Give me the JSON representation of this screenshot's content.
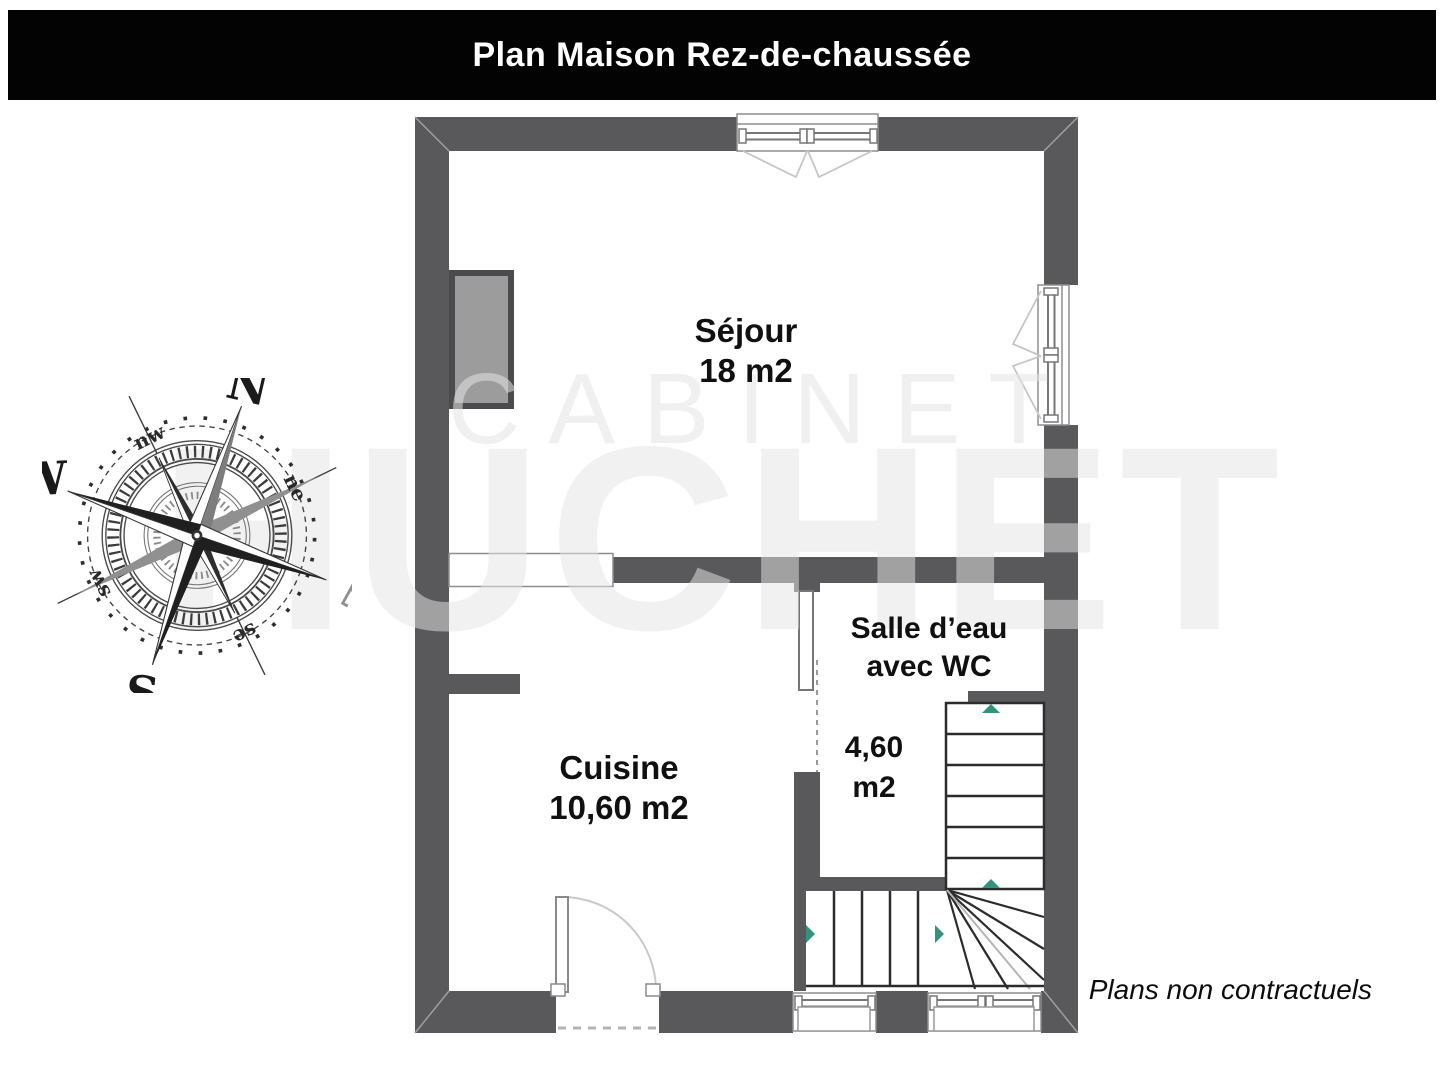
{
  "header": {
    "title": "Plan Maison Rez-de-chaussée"
  },
  "watermark": {
    "line1": "CABINET",
    "line2": "HUCHET"
  },
  "compass": {
    "north": "N",
    "south": "S",
    "east": "E",
    "west": "W",
    "northeast": "ne",
    "northwest": "nw",
    "southeast": "se",
    "southwest": "sw"
  },
  "rooms": {
    "sejour": {
      "name": "Séjour",
      "area": "18 m2"
    },
    "cuisine": {
      "name": "Cuisine",
      "area": "10,60 m2"
    },
    "salle_eau": {
      "name_line1": "Salle d’eau",
      "name_line2": "avec WC",
      "area_line1": "4,60",
      "area_line2": "m2"
    }
  },
  "footer": {
    "note": "Plans non contractuels"
  },
  "colors": {
    "title_bg": "#030303",
    "title_text": "#ffffff",
    "wall": "#59595b",
    "fireplace_fill": "#9c9c9c",
    "stair_arrow": "#2e947c",
    "watermark_gray": "#e4e4e4"
  }
}
